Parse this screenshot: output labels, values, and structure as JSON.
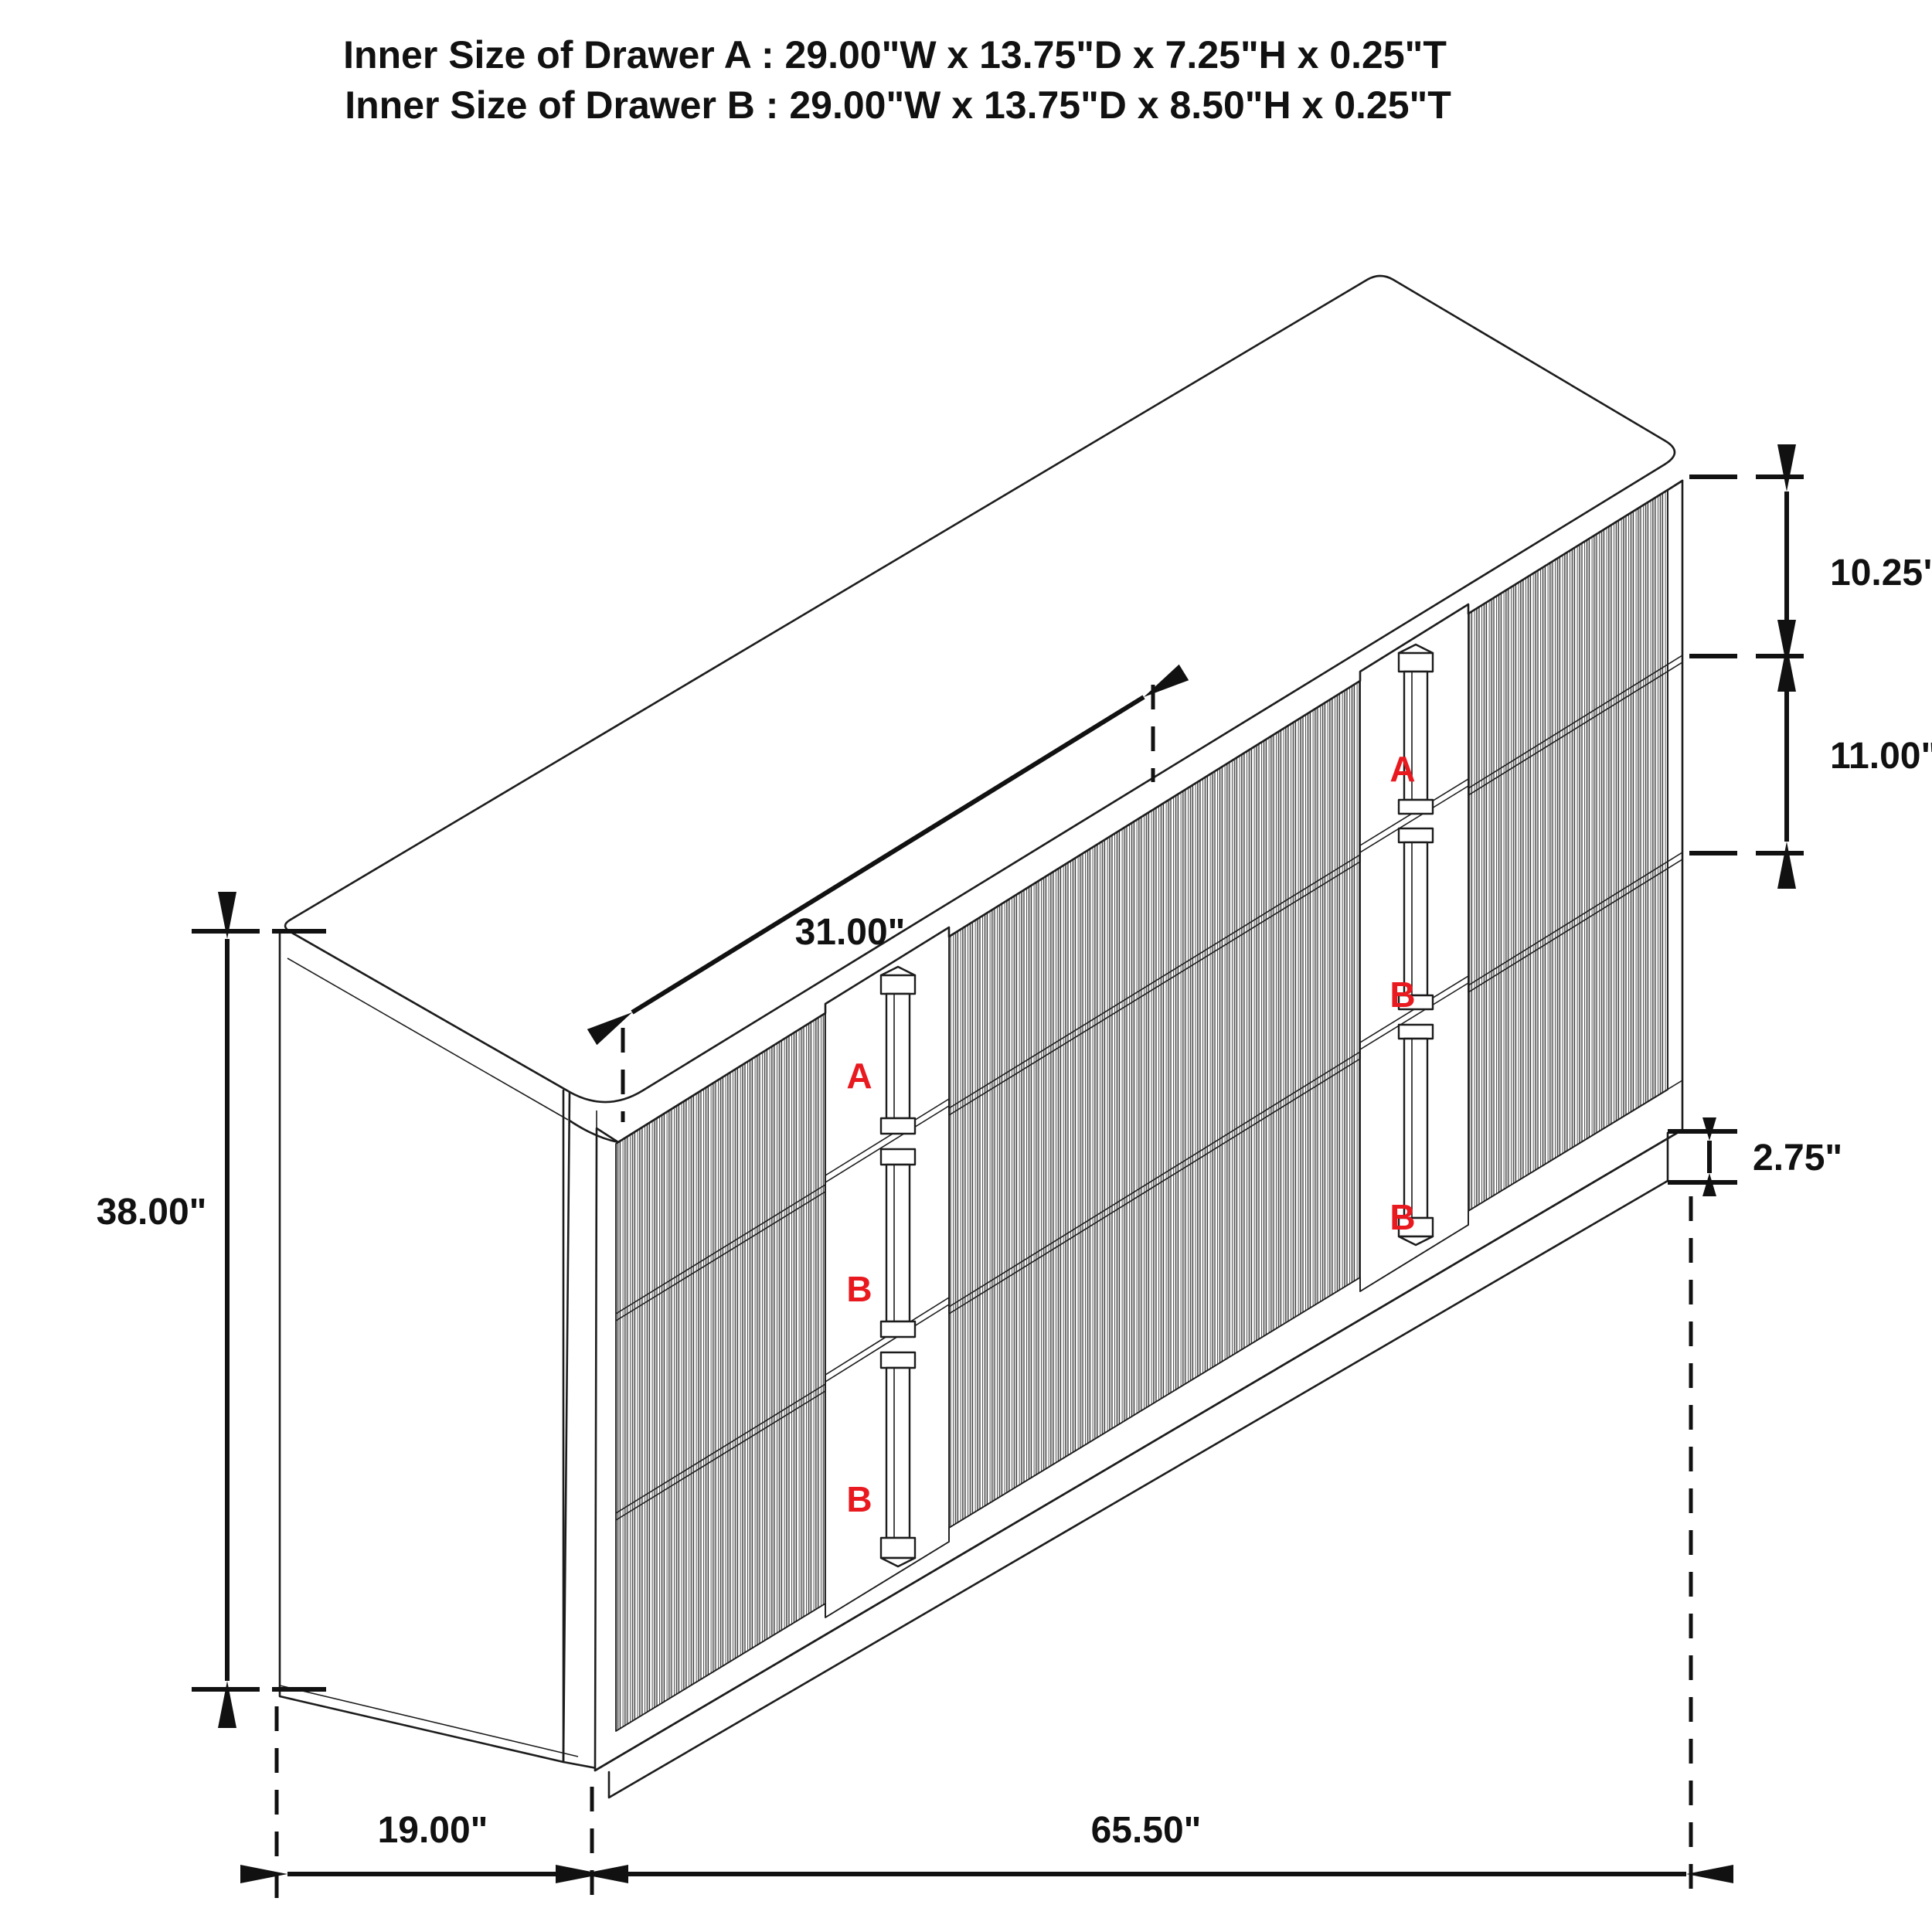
{
  "diagram": {
    "title_line_1": "Inner Size of Drawer A : 29.00\"W x 13.75\"D x 7.25\"H x 0.25\"T",
    "title_line_2": "Inner Size of Drawer B : 29.00\"W x 13.75\"D x 8.50\"H x 0.25\"T"
  },
  "dimensions": {
    "top_drawer_height": "10.25\"",
    "middle_drawer_height": "11.00\"",
    "base_height": "2.75\"",
    "top_width": "31.00\"",
    "overall_height": "38.00\"",
    "depth": "19.00\"",
    "width": "65.50\""
  },
  "drawer_labels": {
    "left": [
      "A",
      "B",
      "B"
    ],
    "right": [
      "A",
      "B",
      "B"
    ]
  },
  "colors": {
    "line": "#1c1c1c",
    "label": "#e8191f",
    "flute": "#c4c4c4"
  }
}
